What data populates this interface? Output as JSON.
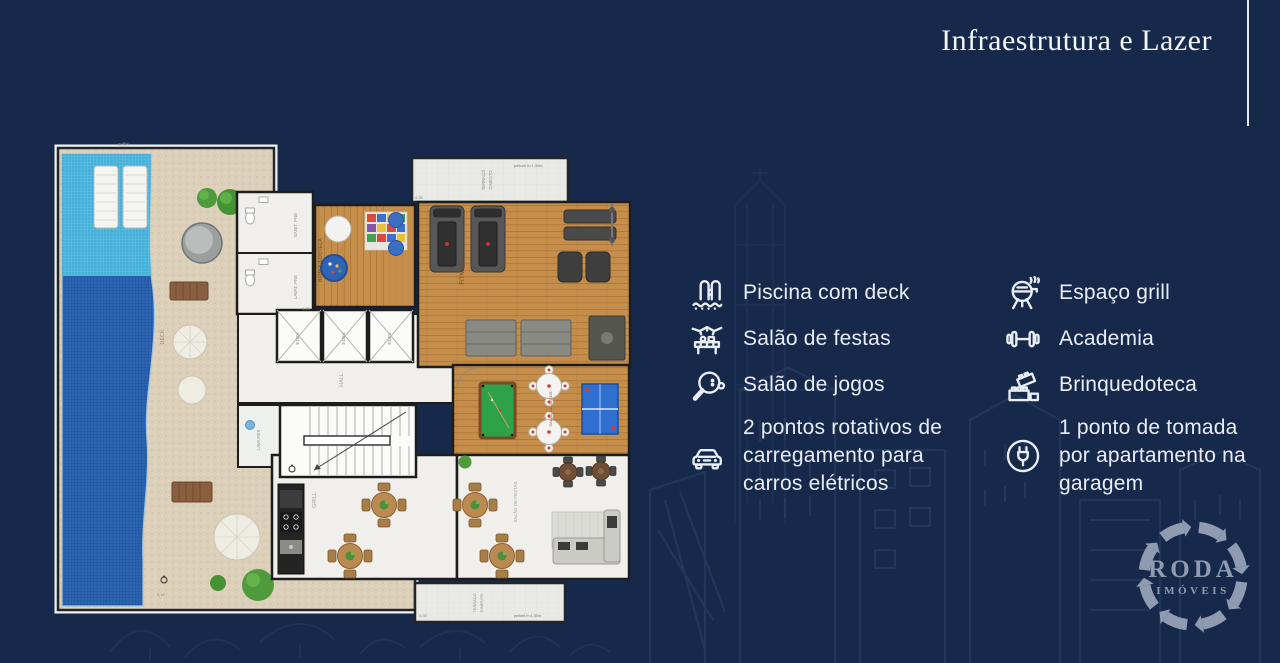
{
  "header": {
    "title": "Infraestrutura e Lazer"
  },
  "amenities": {
    "col1": [
      {
        "icon": "pool-deck-icon",
        "label": "Piscina com deck"
      },
      {
        "icon": "party-room-icon",
        "label": "Salão de festas"
      },
      {
        "icon": "game-room-icon",
        "label": "Salão de jogos"
      },
      {
        "icon": "electric-car-icon",
        "label": "2 pontos rotativos de carregamento para carros elétricos"
      }
    ],
    "col2": [
      {
        "icon": "grill-icon",
        "label": "Espaço grill"
      },
      {
        "icon": "dumbbell-icon",
        "label": "Academia"
      },
      {
        "icon": "toy-blocks-icon",
        "label": "Brinquedoteca"
      },
      {
        "icon": "power-outlet-icon",
        "label": "1 ponto de tomada por apartamento na garagem"
      }
    ]
  },
  "logo": {
    "name": "RODA",
    "subtitle": "IMÓVEIS"
  },
  "floorplan": {
    "calha": "calha",
    "deck_label": "DECK",
    "sanit": "SANIT. PNE",
    "lavatorio": "LAVAT. PNE",
    "brinquedoteca": "BRINQUEDOTECA",
    "fitness": "FITNESS",
    "elev": "ELEV.",
    "hall": "HALL",
    "lava_pes": "LAVA PÉS",
    "jogos": "SALÃO DE JOGOS",
    "festas": "SALÃO DE FESTAS",
    "grill": "GRILL",
    "terraco_l1": "TERRAÇO",
    "terraco_l2": "CIMENTO",
    "peitoril": "peitoril h=1,30m",
    "dims": {
      "d1": "4,35",
      "d2": "5,10",
      "d3": "1,23"
    }
  },
  "colors": {
    "background": "#16294b",
    "accent_text": "#e9edf4",
    "logo": "#8e9bb0",
    "pool": "#2b64b2",
    "pool_shallow": "#44b1db",
    "deck": "#ddd0ba",
    "wood": "#c68e4b",
    "billiard_green": "#2da249",
    "pingpong_blue": "#2e6fd0"
  }
}
